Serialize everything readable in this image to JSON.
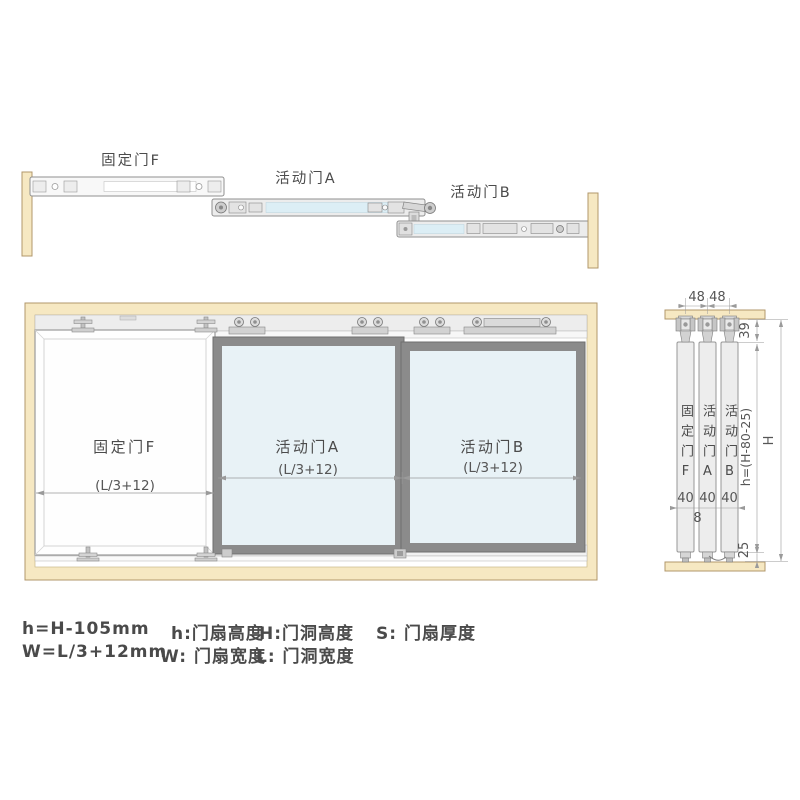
{
  "colors": {
    "wood": "#f6e8c2",
    "wood_border": "#b1976b",
    "glass": "#e8f2f6",
    "door_frame": "#8b8b8b",
    "hardware": "#ececec",
    "track_slot": "#dceef5",
    "line": "#9a9a9a",
    "text": "#4b4b4b"
  },
  "top_assembly": {
    "fixed_door_label": "固定门F",
    "active_door_a_label": "活动门A",
    "active_door_b_label": "活动门B"
  },
  "front_view": {
    "fixed_door": {
      "label": "固定门F",
      "width_dim": "(L/3+12)"
    },
    "active_door_a": {
      "label": "活动门A",
      "width_dim": "(L/3+12)"
    },
    "active_door_b": {
      "label": "活动门B",
      "width_dim": "(L/3+12)"
    }
  },
  "side_view": {
    "hanger_spacing_dim": "48 48",
    "top_clearance_dim": "39",
    "panel_f": {
      "label": "固定门F",
      "thickness_dim": "40"
    },
    "panel_a": {
      "label": "活动门A",
      "thickness_dim": "40"
    },
    "panel_b": {
      "label": "活动门B",
      "thickness_dim": "40"
    },
    "panel_gap_dim": "8",
    "door_height_dim": "h=(H-80-25)",
    "opening_height_dim": "H",
    "bottom_clearance_dim": "25"
  },
  "formulas": {
    "height_formula": "h=H-105mm",
    "h_definition": "h:门扇高度",
    "H_definition": "H:门洞高度",
    "S_definition": "S: 门扇厚度",
    "width_formula": "W=L/3+12mm",
    "W_definition": "W: 门扇宽度",
    "L_definition": "L: 门洞宽度"
  }
}
